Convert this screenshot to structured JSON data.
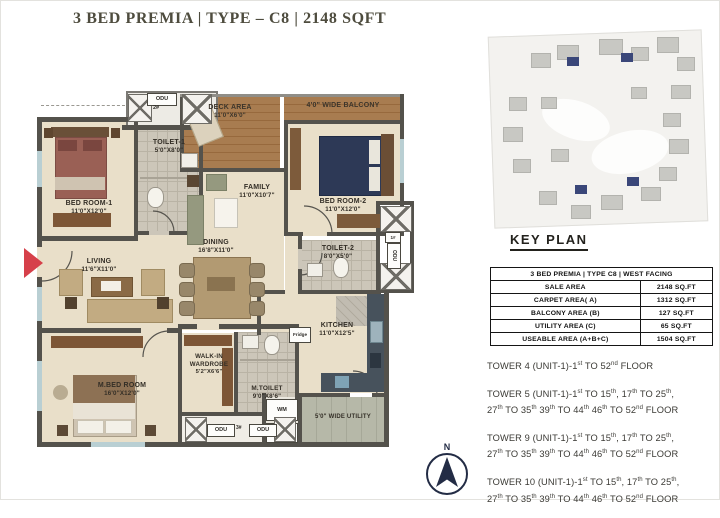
{
  "title": "3 BED PREMIA | TYPE – C8 | 2148 SQFT",
  "colors": {
    "entry_arrow": "#d6404a",
    "keyplan_highlight": "#3a4779",
    "wall": "#54524c",
    "title_text": "#4e4c3e"
  },
  "floorplan": {
    "rooms": {
      "bedroom1": {
        "name": "BED ROOM-1",
        "dim": "11'0\"X12'0\""
      },
      "toilet1": {
        "name": "TOILET-1",
        "dim": "5'0\"X8'0\""
      },
      "deck": {
        "name": "DECK AREA",
        "dim": "11'0\"X6'0\""
      },
      "balcony": {
        "name": "4'0\" WIDE BALCONY"
      },
      "family": {
        "name": "FAMILY",
        "dim": "11'0\"X10'7\""
      },
      "bedroom2": {
        "name": "BED ROOM-2",
        "dim": "11'0\"X12'0\""
      },
      "toilet2": {
        "name": "TOILET-2",
        "dim": "8'0\"X5'0\""
      },
      "living": {
        "name": "LIVING",
        "dim": "11'6\"X11'0\""
      },
      "dining": {
        "name": "DINING",
        "dim": "16'8\"X11'0\""
      },
      "kitchen": {
        "name": "KITCHEN",
        "dim": "11'0\"X12'5\""
      },
      "mbed": {
        "name": "M.BED ROOM",
        "dim": "16'0\"X12'0\""
      },
      "wardrobe": {
        "name": "WALK-IN WARDROBE",
        "dim": "5'2\"X6'6\""
      },
      "mtoilet": {
        "name": "M.TOILET",
        "dim": "9'0\"X8'6\""
      },
      "utility": {
        "name": "5'0\" WIDE UTILITY"
      }
    },
    "labels": {
      "odu": "ODU",
      "odu1_num": "1#",
      "odu2_num": "2#",
      "odu3_num": "3#",
      "wm": "WM",
      "dw": "DW",
      "fridge": "Fridge"
    }
  },
  "key_plan": {
    "label": "KEY PLAN"
  },
  "table": {
    "header": "3 BED PREMIA | TYPE C8 | WEST FACING",
    "rows": [
      {
        "label": "SALE AREA",
        "value": "2148 SQ.FT"
      },
      {
        "label": "CARPET AREA( A)",
        "value": "1312 SQ.FT"
      },
      {
        "label": "BALCONY AREA (B)",
        "value": "127 SQ.FT"
      },
      {
        "label": "UTILITY AREA (C)",
        "value": "65 SQ.FT"
      },
      {
        "label": "USEABLE AREA (A+B+C)",
        "value": "1504 SQ.FT"
      }
    ]
  },
  "towers": [
    {
      "lines": [
        [
          {
            "t": "TOWER 4 (UNIT-1)-1"
          },
          {
            "t": "st",
            "sup": true
          },
          {
            "t": " TO 52"
          },
          {
            "t": "nd",
            "sup": true
          },
          {
            "t": " FLOOR"
          }
        ]
      ]
    },
    {
      "lines": [
        [
          {
            "t": "TOWER 5 (UNIT-1)-1"
          },
          {
            "t": "st",
            "sup": true
          },
          {
            "t": " TO 15"
          },
          {
            "t": "th",
            "sup": true
          },
          {
            "t": ", 17"
          },
          {
            "t": "th",
            "sup": true
          },
          {
            "t": " TO 25"
          },
          {
            "t": "th",
            "sup": true
          },
          {
            "t": ","
          }
        ],
        [
          {
            "t": "27"
          },
          {
            "t": "th",
            "sup": true
          },
          {
            "t": " TO 35"
          },
          {
            "t": "th",
            "sup": true
          },
          {
            "t": " 39"
          },
          {
            "t": "th",
            "sup": true
          },
          {
            "t": " TO 44"
          },
          {
            "t": "th",
            "sup": true
          },
          {
            "t": " 46"
          },
          {
            "t": "th",
            "sup": true
          },
          {
            "t": " TO 52"
          },
          {
            "t": "nd",
            "sup": true
          },
          {
            "t": " FLOOR"
          }
        ]
      ]
    },
    {
      "lines": [
        [
          {
            "t": "TOWER 9 (UNIT-1)-1"
          },
          {
            "t": "st",
            "sup": true
          },
          {
            "t": " TO 15"
          },
          {
            "t": "th",
            "sup": true
          },
          {
            "t": ", 17"
          },
          {
            "t": "th",
            "sup": true
          },
          {
            "t": " TO 25"
          },
          {
            "t": "th",
            "sup": true
          },
          {
            "t": ","
          }
        ],
        [
          {
            "t": "27"
          },
          {
            "t": "th",
            "sup": true
          },
          {
            "t": " TO 35"
          },
          {
            "t": "th",
            "sup": true
          },
          {
            "t": " 39"
          },
          {
            "t": "th",
            "sup": true
          },
          {
            "t": " TO 44"
          },
          {
            "t": "th",
            "sup": true
          },
          {
            "t": " 46"
          },
          {
            "t": "th",
            "sup": true
          },
          {
            "t": " TO 52"
          },
          {
            "t": "nd",
            "sup": true
          },
          {
            "t": " FLOOR"
          }
        ]
      ]
    },
    {
      "lines": [
        [
          {
            "t": "TOWER 10 (UNIT-1)-1"
          },
          {
            "t": "st",
            "sup": true
          },
          {
            "t": " TO 15"
          },
          {
            "t": "th",
            "sup": true
          },
          {
            "t": ", 17"
          },
          {
            "t": "th",
            "sup": true
          },
          {
            "t": " TO 25"
          },
          {
            "t": "th",
            "sup": true
          },
          {
            "t": ","
          }
        ],
        [
          {
            "t": "27"
          },
          {
            "t": "th",
            "sup": true
          },
          {
            "t": " TO 35"
          },
          {
            "t": "th",
            "sup": true
          },
          {
            "t": " 39"
          },
          {
            "t": "th",
            "sup": true
          },
          {
            "t": " TO 44"
          },
          {
            "t": "th",
            "sup": true
          },
          {
            "t": " 46"
          },
          {
            "t": "th",
            "sup": true
          },
          {
            "t": " TO 52"
          },
          {
            "t": "nd",
            "sup": true
          },
          {
            "t": " FLOOR"
          }
        ]
      ]
    }
  ],
  "compass": {
    "north_label": "N"
  }
}
